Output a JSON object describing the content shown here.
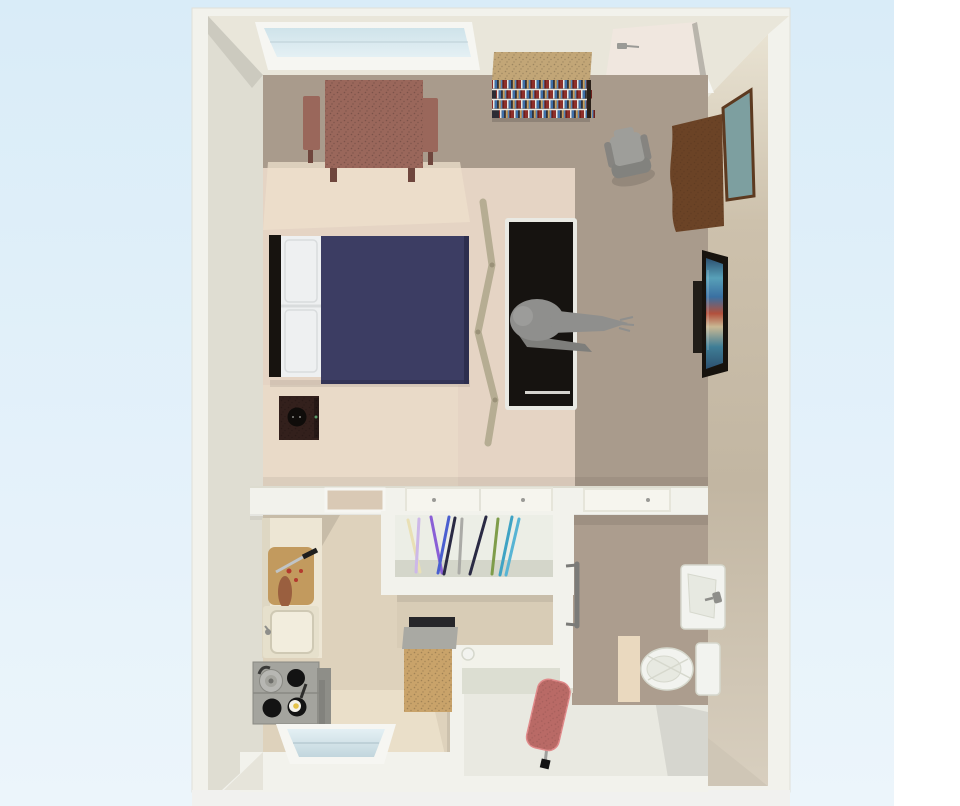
{
  "scene": {
    "type": "3d-floorplan-top-view",
    "description": "Bird's-eye 3D render of a studio apartment",
    "rooms": [
      {
        "name": "studio-room",
        "items": [
          "skylight window",
          "dining table with two chairs",
          "bookshelf",
          "entry door",
          "armchair",
          "dresser with mirror",
          "double bed with navy blanket",
          "speaker",
          "folding screen divider",
          "black sofa with seated person",
          "wall-mounted tv"
        ]
      },
      {
        "name": "kitchen",
        "items": [
          "counter",
          "cutting board with knife",
          "sink",
          "stove with pot and frying pan",
          "window"
        ]
      },
      {
        "name": "closet",
        "items": [
          "leaning skis and poles"
        ]
      },
      {
        "name": "hallway",
        "items": [
          "cabinet",
          "side table",
          "ironing board"
        ]
      },
      {
        "name": "bathroom",
        "items": [
          "wall sink",
          "toilet",
          "bath mat",
          "towel bar"
        ]
      }
    ]
  },
  "colors": {
    "bg_top": "#d9ecf8",
    "bg_bottom": "#ecf5fb",
    "side_white": "#ffffff",
    "bottom_strip": "#f1f1ef",
    "wall_white": "#f2f2ec",
    "wall_edge": "#e0e0d8",
    "ceiling_face": "#e9e6da",
    "left_face": "#dfddd2",
    "left_face_dark": "#c7c5ba",
    "corner_dark": "#cfc6b6",
    "corner_light": "#e6e4da",
    "floor_taupe": "#a99b8c",
    "floor_pink": "#e5d4c4",
    "floor_light": "#eee0cc",
    "kitchen_floor": "#ded2bc",
    "kitchen_light": "#ebe0ca",
    "hall_floor": "#e9e9e1",
    "bath_floor": "#ac9d8e",
    "niche_floor": "#d8ccb6",
    "rw_top": "#e9e3d3",
    "rw_mid": "#cdc1ac",
    "rw_mid2": "#c2b6a2",
    "rw_bot": "#d8cfbf",
    "glass_light": "#e4f0f4",
    "glass_dark": "#c2d6dd",
    "glass_top": "#cfe3ea",
    "frame_white": "#f6f6f2",
    "glass_line": "#a9bec6",
    "door_cream": "#f0e7df",
    "door_edge": "#b9b5ac",
    "handle_gray": "#9a9a96",
    "bar_gray": "#7b7b78",
    "band_line": "#dddcd0",
    "th_beige": "#d9c9b5",
    "th_white": "#f6f5ee",
    "th_line": "#e6e5da",
    "table_brown": "#9a675b",
    "table_dark": "#6f463d",
    "shelf_tan": "#c2a677",
    "book_red": "#8e2f2a",
    "book_red2": "#6e1f1c",
    "book_white": "#e8e6e0",
    "book_blue": "#3f6fa8",
    "book_blue2": "#5a88b8",
    "book_dark": "#2c2c34",
    "book_tan": "#c8a060",
    "shelf_side": "#2a2019",
    "shelf_line": "#e9e7df",
    "chair_gray": "#9e9e9a",
    "chair_gray_dark": "#82827e",
    "dresser_brown": "#6b4326",
    "mirror_teal": "#7d9fa0",
    "mirror_frame": "#5d3a20",
    "headboard": "#17130f",
    "pillow": "#eef0f1",
    "pillow_line": "#d9dcdd",
    "bed_navy": "#3c3d63",
    "bed_navy_dark": "#2d2e4e",
    "speaker_maroon": "#33201c",
    "speaker_black": "#0f0c0a",
    "speaker_led": "#5a9a6a",
    "speaker_dot": "#8a8a86",
    "screen_tan": "#b6ad93",
    "screen_dark": "#9a9178",
    "sofa_trim": "#e9e9e3",
    "sofa_black": "#161310",
    "person": "#8f8f8d",
    "person_light": "#9c9c9a",
    "person_dark": "#7e7e7b",
    "tv_mount": "#211d18",
    "tv_frame": "#17130e",
    "tv1": "#2c5070",
    "tv2": "#58a0b8",
    "tv3": "#3a70a2",
    "tv4": "#b2503c",
    "tv5": "#c9b894",
    "tv6": "#3f7e96",
    "counter_cream": "#ede6d4",
    "counter_face": "#ded7c3",
    "board_tan": "#c29a5e",
    "knife_handle": "#1e1e1e",
    "knife_blade": "#c0c4c6",
    "tomato": "#b33a2e",
    "bread": "#9a5f3f",
    "sink_outer": "#e6e0cc",
    "sink_basin": "#f2eddd",
    "sink_line": "#cfc9b4",
    "faucet": "#8e8e8a",
    "stove_top": "#a4a49e",
    "stove_side": "#8e8e88",
    "stove_line": "#898983",
    "burner": "#131313",
    "pot": "#b7b7b3",
    "pot_dark": "#6e6e6a",
    "pot_handle": "#3a3a38",
    "egg": "#f4f2ea",
    "yolk": "#e5c34a",
    "pan_handle": "#2e2e2c",
    "closet_floor": "#eceee6",
    "closet_shadow": "#d4d6ca",
    "ski_cream": "#e9e0b5",
    "ski_lav": "#cdb8e8",
    "ski_purple": "#8a5fd6",
    "ski_blue": "#4a5fd0",
    "ski_navy": "#2a2a44",
    "ski_gray": "#aaaaa6",
    "ski_olive": "#7e9c4a",
    "ski_teal": "#3fa3c4",
    "ski_teal2": "#57b4d4",
    "cab_tan": "#c9a36a",
    "cab_top": "#a9a9a3",
    "cab_dark": "#26262a",
    "tbl_top": "#f2f2ea",
    "tbl_face": "#dcded2",
    "iron_red": "#b96a66",
    "iron_pink": "#e08a8a",
    "iron_leg": "#a0a09c",
    "iron_foot": "#141414",
    "fix_white": "#f2f3ef",
    "fix_line": "#d6d8cd",
    "fix_inner": "#e7e9e1",
    "mat": "#ead9bf",
    "shadow": "#000000"
  }
}
